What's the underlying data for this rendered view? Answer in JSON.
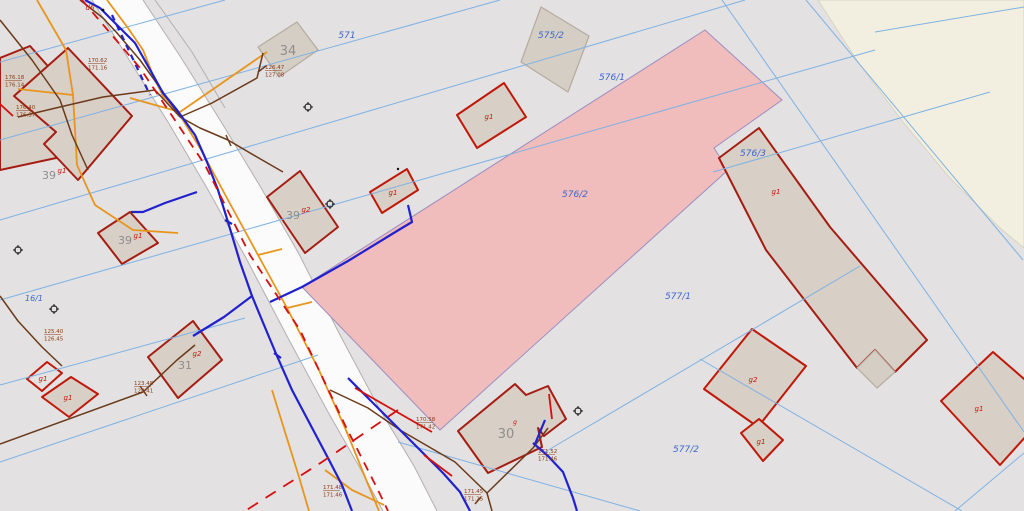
{
  "map": {
    "title": "Cadastral map view",
    "highlighted_parcel": "576/2",
    "colors": {
      "background": "#e3e1e2",
      "terrain_fill": "#f2efe0",
      "road_fill": "#fbfbfb",
      "road_edge": "#b3b0ae",
      "parcel_line": "#7fb2e3",
      "parcel_label": "#3b66cc",
      "highlight_fill": "#f1bcbc",
      "highlight_edge": "#9b8fc2",
      "building_fill": "#d8cfc6",
      "building_outline": "#a51d12",
      "building_muted_outline": "#b5ab9f",
      "number_label": "#8f8d8b",
      "red_label": "#c41808",
      "water_line": "#2121ce",
      "gas_line": "#e8951d",
      "telecom_line": "#6b3a1a",
      "power_line": "#d40f0f",
      "measurement_label": "#8a3c14"
    },
    "parcels": [
      {
        "text": "571"
      },
      {
        "text": "575/2"
      },
      {
        "text": "576/1"
      },
      {
        "text": "576/2"
      },
      {
        "text": "576/3"
      },
      {
        "text": "577/1"
      },
      {
        "text": "577/2"
      },
      {
        "text": "16/1"
      }
    ],
    "buildings": {
      "n34": "34",
      "n30": "30",
      "n39": "39",
      "n31": "31",
      "g1": "g1",
      "g2": "g2",
      "g": "g",
      "d6": "d6"
    },
    "measurements": [
      {
        "top": "170.62",
        "bottom": "171.16"
      },
      {
        "top": "126.47",
        "bottom": "127.08"
      },
      {
        "top": "176.18",
        "bottom": "176.14"
      },
      {
        "top": "176.40",
        "bottom": "176.37"
      },
      {
        "top": "125.40",
        "bottom": "126.45"
      },
      {
        "top": "123.48",
        "bottom": "128.41"
      },
      {
        "top": "171.48",
        "bottom": "171.46"
      },
      {
        "top": "170.58",
        "bottom": "171.42"
      },
      {
        "top": "171.52",
        "bottom": "171.46"
      },
      {
        "top": "171.45",
        "bottom": "171.25"
      }
    ],
    "symbols": {
      "survey_points": 5
    }
  }
}
